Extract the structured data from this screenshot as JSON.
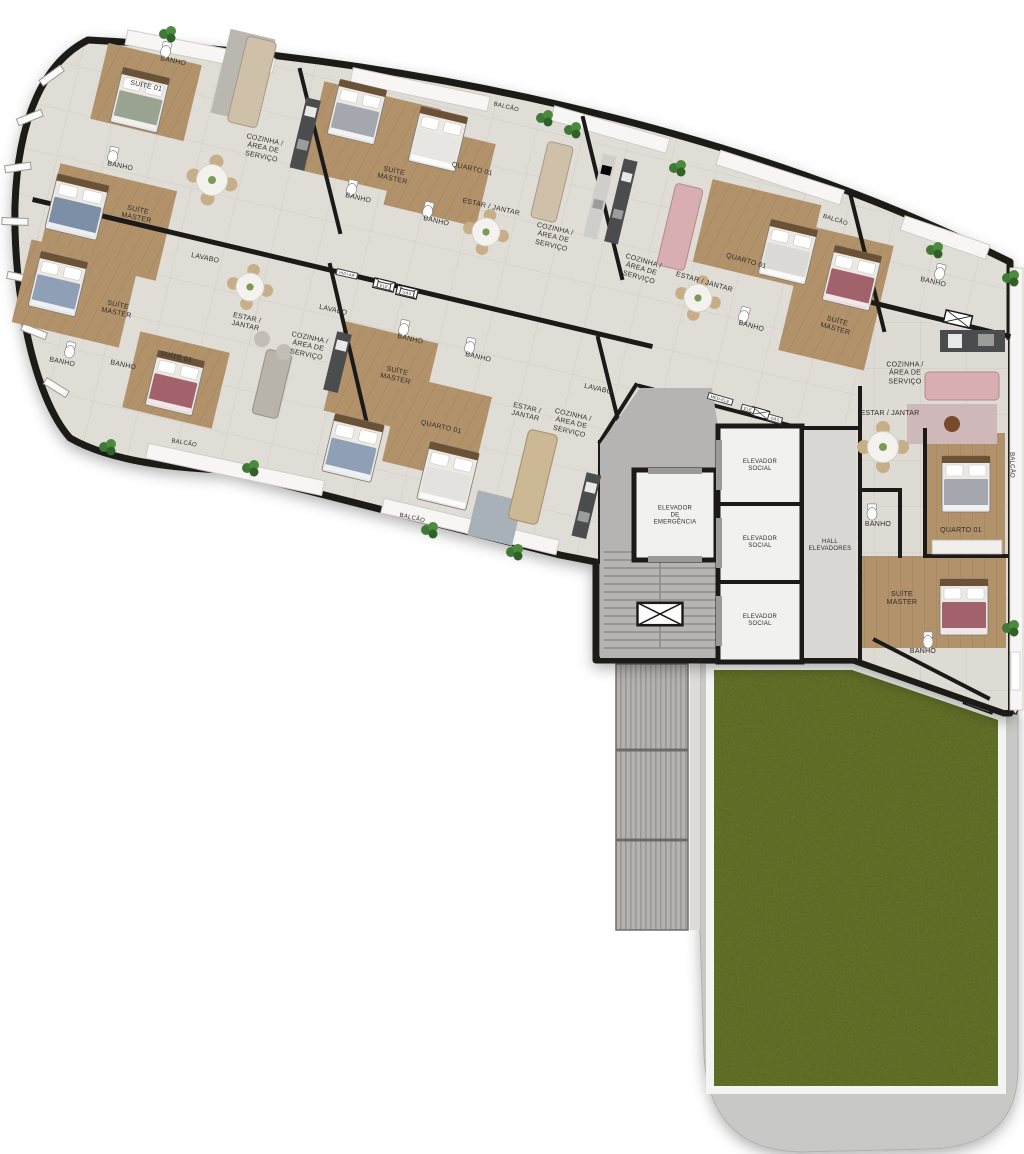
{
  "meta": {
    "width": 1024,
    "height": 1154,
    "description": "Residential tower floor plan (pavimento tipo) with five tilted apartment units, elevator core, ramp and private garden terrace"
  },
  "palette": {
    "wall": "#1b1a18",
    "tile": "#e0ddd6",
    "tileLine": "#cfccc4",
    "wood": "#b2926a",
    "woodLine": "#8a6c48",
    "core": "#b5b4b2",
    "hall": "#d8d7d4",
    "stairs": "#abaaa8",
    "ramp": "#b3b2b0",
    "rampRib": "#999896",
    "terrace": "#c8c8c6",
    "frame": "#f4f4f2",
    "grass": "#57651f",
    "grassDark": "#3a4412",
    "balcony": "#f7f6f4",
    "label": "#2e2d2b",
    "bedBlue": "#8fa0b6",
    "bedRed": "#a1626b",
    "bedGray": "#a4a8ae",
    "bedWhite": "#e8e6e2",
    "bedGreen": "#9aa392",
    "sofa": "#cfc0aa",
    "sofaPink": "#d9aeb2",
    "counter": "#4a4c4d",
    "plant": "#3e7a35"
  },
  "labels": [
    {
      "t": "BANHO",
      "x": 173,
      "y": 62,
      "r": 12,
      "s": 7
    },
    {
      "t": "SUÍTE 01",
      "x": 146,
      "y": 87,
      "r": 12,
      "s": 7
    },
    {
      "t": "BANHO",
      "x": 120,
      "y": 167,
      "r": 12,
      "s": 7
    },
    {
      "t": "SUÍTE\nMASTER",
      "x": 137,
      "y": 215,
      "r": 12,
      "s": 7
    },
    {
      "t": "COZINHA /\nÁREA DE\nSERVIÇO",
      "x": 263,
      "y": 149,
      "r": 12,
      "s": 7
    },
    {
      "t": "BALCÃO",
      "x": 506,
      "y": 108,
      "r": 14,
      "s": 6
    },
    {
      "t": "SUÍTE\nMASTER",
      "x": 393,
      "y": 176,
      "r": 13,
      "s": 7
    },
    {
      "t": "QUARTO 01",
      "x": 472,
      "y": 170,
      "r": 13,
      "s": 7
    },
    {
      "t": "BANHO",
      "x": 358,
      "y": 199,
      "r": 13,
      "s": 7
    },
    {
      "t": "BANHO",
      "x": 436,
      "y": 222,
      "r": 13,
      "s": 7
    },
    {
      "t": "ESTAR / JANTAR",
      "x": 491,
      "y": 208,
      "r": 13,
      "s": 7
    },
    {
      "t": "COZINHA /\nÁREA DE\nSERVIÇO",
      "x": 553,
      "y": 238,
      "r": 13,
      "s": 7
    },
    {
      "t": "LAVABO",
      "x": 205,
      "y": 259,
      "r": 12,
      "s": 7
    },
    {
      "t": "COZINHA /\nÁREA DE\nSERVIÇO",
      "x": 641,
      "y": 270,
      "r": 16,
      "s": 7
    },
    {
      "t": "ESTAR / JANTAR",
      "x": 704,
      "y": 283,
      "r": 16,
      "s": 7
    },
    {
      "t": "QUARTO 01",
      "x": 746,
      "y": 262,
      "r": 16,
      "s": 7
    },
    {
      "t": "BALCÃO",
      "x": 835,
      "y": 221,
      "r": 18,
      "s": 6
    },
    {
      "t": "SUÍTE\nMASTER",
      "x": 836,
      "y": 326,
      "r": 16,
      "s": 7
    },
    {
      "t": "BANHO",
      "x": 751,
      "y": 327,
      "r": 16,
      "s": 7
    },
    {
      "t": "SUÍTE\nMASTER",
      "x": 117,
      "y": 310,
      "r": 12,
      "s": 7
    },
    {
      "t": "BANHO",
      "x": 62,
      "y": 363,
      "r": 12,
      "s": 7
    },
    {
      "t": "BANHO",
      "x": 123,
      "y": 366,
      "r": 12,
      "s": 7
    },
    {
      "t": "SUÍTE 01",
      "x": 176,
      "y": 358,
      "r": 12,
      "s": 7
    },
    {
      "t": "ESTAR /\nJANTAR",
      "x": 246,
      "y": 323,
      "r": 12,
      "s": 7
    },
    {
      "t": "COZINHA /\nÁREA DE\nSERVIÇO",
      "x": 308,
      "y": 347,
      "r": 12,
      "s": 7
    },
    {
      "t": "BALCÃO",
      "x": 184,
      "y": 444,
      "r": 10,
      "s": 6
    },
    {
      "t": "LAVABO",
      "x": 333,
      "y": 311,
      "r": 13,
      "s": 7
    },
    {
      "t": "SUÍTE\nMASTER",
      "x": 396,
      "y": 376,
      "r": 13,
      "s": 7
    },
    {
      "t": "QUARTO 01",
      "x": 441,
      "y": 428,
      "r": 13,
      "s": 7
    },
    {
      "t": "BANHO",
      "x": 410,
      "y": 340,
      "r": 13,
      "s": 7
    },
    {
      "t": "BANHO",
      "x": 478,
      "y": 358,
      "r": 13,
      "s": 7
    },
    {
      "t": "ESTAR /\nJANTAR",
      "x": 526,
      "y": 413,
      "r": 13,
      "s": 7
    },
    {
      "t": "COZINHA /\nÁREA DE\nSERVIÇO",
      "x": 571,
      "y": 424,
      "r": 13,
      "s": 7
    },
    {
      "t": "LAVABO",
      "x": 598,
      "y": 390,
      "r": 13,
      "s": 7
    },
    {
      "t": "BALCÃO",
      "x": 412,
      "y": 519,
      "r": 13,
      "s": 6
    },
    {
      "t": "BANHO",
      "x": 933,
      "y": 283,
      "r": 13,
      "s": 7
    },
    {
      "t": "COZINHA /\nÁREA DE\nSERVIÇO",
      "x": 905,
      "y": 374,
      "r": 0,
      "s": 7
    },
    {
      "t": "ESTAR / JANTAR",
      "x": 890,
      "y": 414,
      "r": 0,
      "s": 7
    },
    {
      "t": "QUARTO 01",
      "x": 961,
      "y": 531,
      "r": 0,
      "s": 7
    },
    {
      "t": "BANHO",
      "x": 878,
      "y": 525,
      "r": 0,
      "s": 7
    },
    {
      "t": "SUÍTE\nMASTER",
      "x": 902,
      "y": 599,
      "r": 0,
      "s": 7
    },
    {
      "t": "BANHO",
      "x": 923,
      "y": 652,
      "r": 0,
      "s": 7
    },
    {
      "t": "BALCÃO",
      "x": 1011,
      "y": 465,
      "r": 90,
      "s": 6
    },
    {
      "t": "ELEVADOR\nDE\nEMERGÊNCIA",
      "x": 675,
      "y": 516,
      "r": 0,
      "s": 6
    },
    {
      "t": "ELEVADOR\nSOCIAL",
      "x": 760,
      "y": 466,
      "r": 0,
      "s": 6
    },
    {
      "t": "ELEVADOR\nSOCIAL",
      "x": 760,
      "y": 543,
      "r": 0,
      "s": 6
    },
    {
      "t": "ELEVADOR\nSOCIAL",
      "x": 760,
      "y": 621,
      "r": 0,
      "s": 6
    },
    {
      "t": "HALL\nELEVADORES",
      "x": 830,
      "y": 546,
      "r": 0,
      "s": 6
    },
    {
      "t": "HID+AR",
      "x": 347,
      "y": 274,
      "r": 13,
      "s": 4
    },
    {
      "t": "ELE",
      "x": 384,
      "y": 286,
      "r": 13,
      "s": 4
    },
    {
      "t": "GÁS",
      "x": 407,
      "y": 293,
      "r": 13,
      "s": 4
    },
    {
      "t": "MED-ELE",
      "x": 720,
      "y": 399,
      "r": 16,
      "s": 4
    },
    {
      "t": "ELE",
      "x": 748,
      "y": 409,
      "r": 16,
      "s": 4
    },
    {
      "t": "GÁS",
      "x": 775,
      "y": 419,
      "r": 16,
      "s": 4
    }
  ]
}
